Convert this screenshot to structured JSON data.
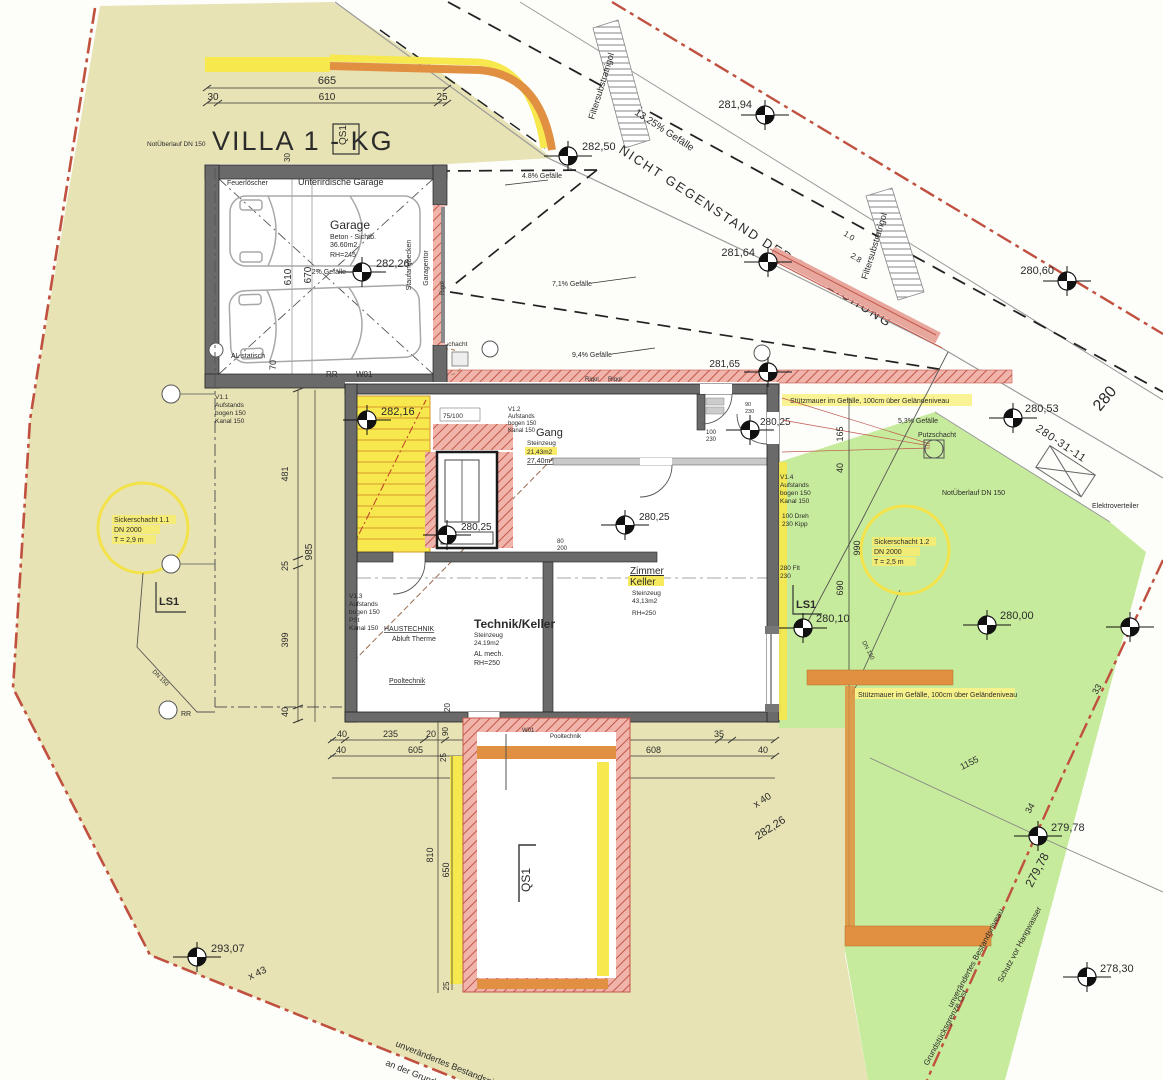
{
  "title": "VILLA 1 - KG",
  "section": {
    "qs1_box": "QS1",
    "qs1_pool": "QS1",
    "ls1_left": "LS1",
    "ls1_right": "LS1"
  },
  "garage": {
    "room": "Unterirdische Garage",
    "name": "Garage",
    "spec1": "Beton - Sichtb.",
    "spec2": "36.60m2",
    "spec3": "RH=245",
    "fire": "Feuerlöscher",
    "slope": "2% Gefälle",
    "al": "AL statisch",
    "door": "Garagentor",
    "basin": "Staufangbecken",
    "rr": "RR",
    "wm": "W01",
    "rigol": "Rigol",
    "rigol2": "Rigol",
    "rigol3": "Rigol"
  },
  "rooms": {
    "gang": {
      "n": "Gang",
      "m": "Steinzeug",
      "a1": "21,43m2",
      "a2": "27,40m²"
    },
    "zimmer": {
      "n1": "Zimmer",
      "n2": "Keller",
      "m": "Steinzeug",
      "a": "43,13m2",
      "rh": "RH=250"
    },
    "technik": {
      "n": "Technik/Keller",
      "m": "Steinzeug",
      "a": "24.19m2",
      "al": "AL mech.",
      "rh": "RH=250"
    },
    "haus1": "HAUSTECHNIK",
    "haus2": "Abluft Therme",
    "pool1": "Pooltechnik",
    "pool2": "Pooltechnik",
    "w01": "W01"
  },
  "tags": {
    "lift": "75/100",
    "hall_a": "80",
    "hall_b": "200",
    "gang_a": "100",
    "gang_b": "230",
    "entry_a": "90",
    "entry_b": "230"
  },
  "elev": {
    "e_garage": "282,26",
    "e_ramp": "282,50",
    "e_road1": "281,94",
    "e_road2": "281,64",
    "e_road3": "280,60",
    "e_court": "281,65",
    "e_stair": "282,16",
    "e_hall": "280,25",
    "e_zimmer": "280,25",
    "e_entry": "280,25",
    "e_lawn1": "280,53",
    "e_lawn2": "280,10",
    "e_lawn3": "280,00",
    "e_slope": "279,78",
    "e_east": "278,30",
    "e_sw": "293,07"
  },
  "dims": {
    "top_total": "665",
    "top_a": "30",
    "top_b": "610",
    "top_c": "25",
    "gar_w": "610",
    "gar_w2": "670",
    "gar_s": "70",
    "gar_n": "30",
    "left_a": "481",
    "left_total": "985",
    "left_b": "25",
    "left_c": "399",
    "left_d": "40",
    "bot1_a": "40",
    "bot1_b": "235",
    "bot1_c": "20",
    "bot1_e": "165",
    "bot1_f": "655",
    "bot1_g": "35",
    "bot2_a": "40",
    "bot2_b": "605",
    "bot2_d": "10",
    "bot2_e": "608",
    "bot2_f": "40",
    "w20": "20",
    "w90": "90",
    "w25": "25",
    "bot_total": "1303",
    "pool_a": "810",
    "pool_b": "650",
    "pool_c": "25",
    "right_a": "165",
    "right_b": "40",
    "right_c": "990",
    "right_d": "690",
    "r1155": "1155"
  },
  "road": {
    "not_subject": "NICHT GEGENSTAND DER EINREICHUNG",
    "slope": "13,25% Gefälle",
    "filter1": "Filtersubstratrigol",
    "filter2": "Filtersubstratrigol"
  },
  "slopes": {
    "s48": "4.8% Gefälle",
    "s71": "7,1% Gefälle",
    "s94": "9,4% Gefälle",
    "s53": "5,3% Gefälle"
  },
  "site": {
    "stuetz1": "Stützmauer im Gefälle, 100cm über Geländeniveau",
    "stuetz2": "Stützmauer im Gefälle, 100cm über Geländeniveau",
    "not1": "NotÜberlauf DN 150",
    "not2": "NotÜberlauf DN 150",
    "s11a": "Sickerschacht 1.1",
    "s11b": "DN 2000",
    "s11c": "T = 2,9 m",
    "s12a": "Sickerschacht 1.2",
    "s12b": "DN 2000",
    "s12c": "T = 2,5 m",
    "putz1": "Putzschacht",
    "putz2": "Putzschacht",
    "elektro": "Elektroverteiler",
    "dn1": "DN 150",
    "dn2": "DN 150",
    "rr": "RR",
    "east1": "unverändertes Bestandsniveau",
    "east2": "Grundstücksgrenze Ost",
    "east3": "Schutz vor Hangwasser",
    "south1": "unverändertes Bestandsniveau",
    "south2": "an der Grundstücksgrenze"
  },
  "valves": {
    "v11a": "V1.1",
    "v11b": "Aufstands",
    "v11c": "bogen 150",
    "v11d": "Kanal 150",
    "v12a": "V1.2",
    "v12b": "Aufstands",
    "v12c": "bogen 150",
    "v12d": "Kanal 150",
    "v13a": "V1.3",
    "v13b": "Aufstands",
    "v13c": "bogen 150",
    "v13d": "PSt",
    "v13e": "Kanal 150",
    "v14a": "V1.4",
    "v14b": "Aufstands",
    "v14c": "bogen 150",
    "v14d": "Kanal 150",
    "v14e": "100 Dreh",
    "v14f": "230 Kipp",
    "v14g": "280 Flt",
    "v14h": "230"
  },
  "rot": {
    "g280": "280",
    "g280_31": "280-31-11",
    "g33": "33",
    "g34": "34",
    "g43": "x 43",
    "g40": "x 40",
    "g282": "282,26",
    "g279": "279,78",
    "g10": "1.0",
    "g28": "2.8"
  },
  "colors": {
    "site_beige": "#e7e3b4",
    "lawn_green": "#c7eb9c",
    "highlight_yellow": "#f6e84d",
    "wall_grey": "#6a6a6a",
    "retaining_orange": "#e09040",
    "pink_wall": "#f0b4aa",
    "boundary_red": "#c0503f"
  }
}
